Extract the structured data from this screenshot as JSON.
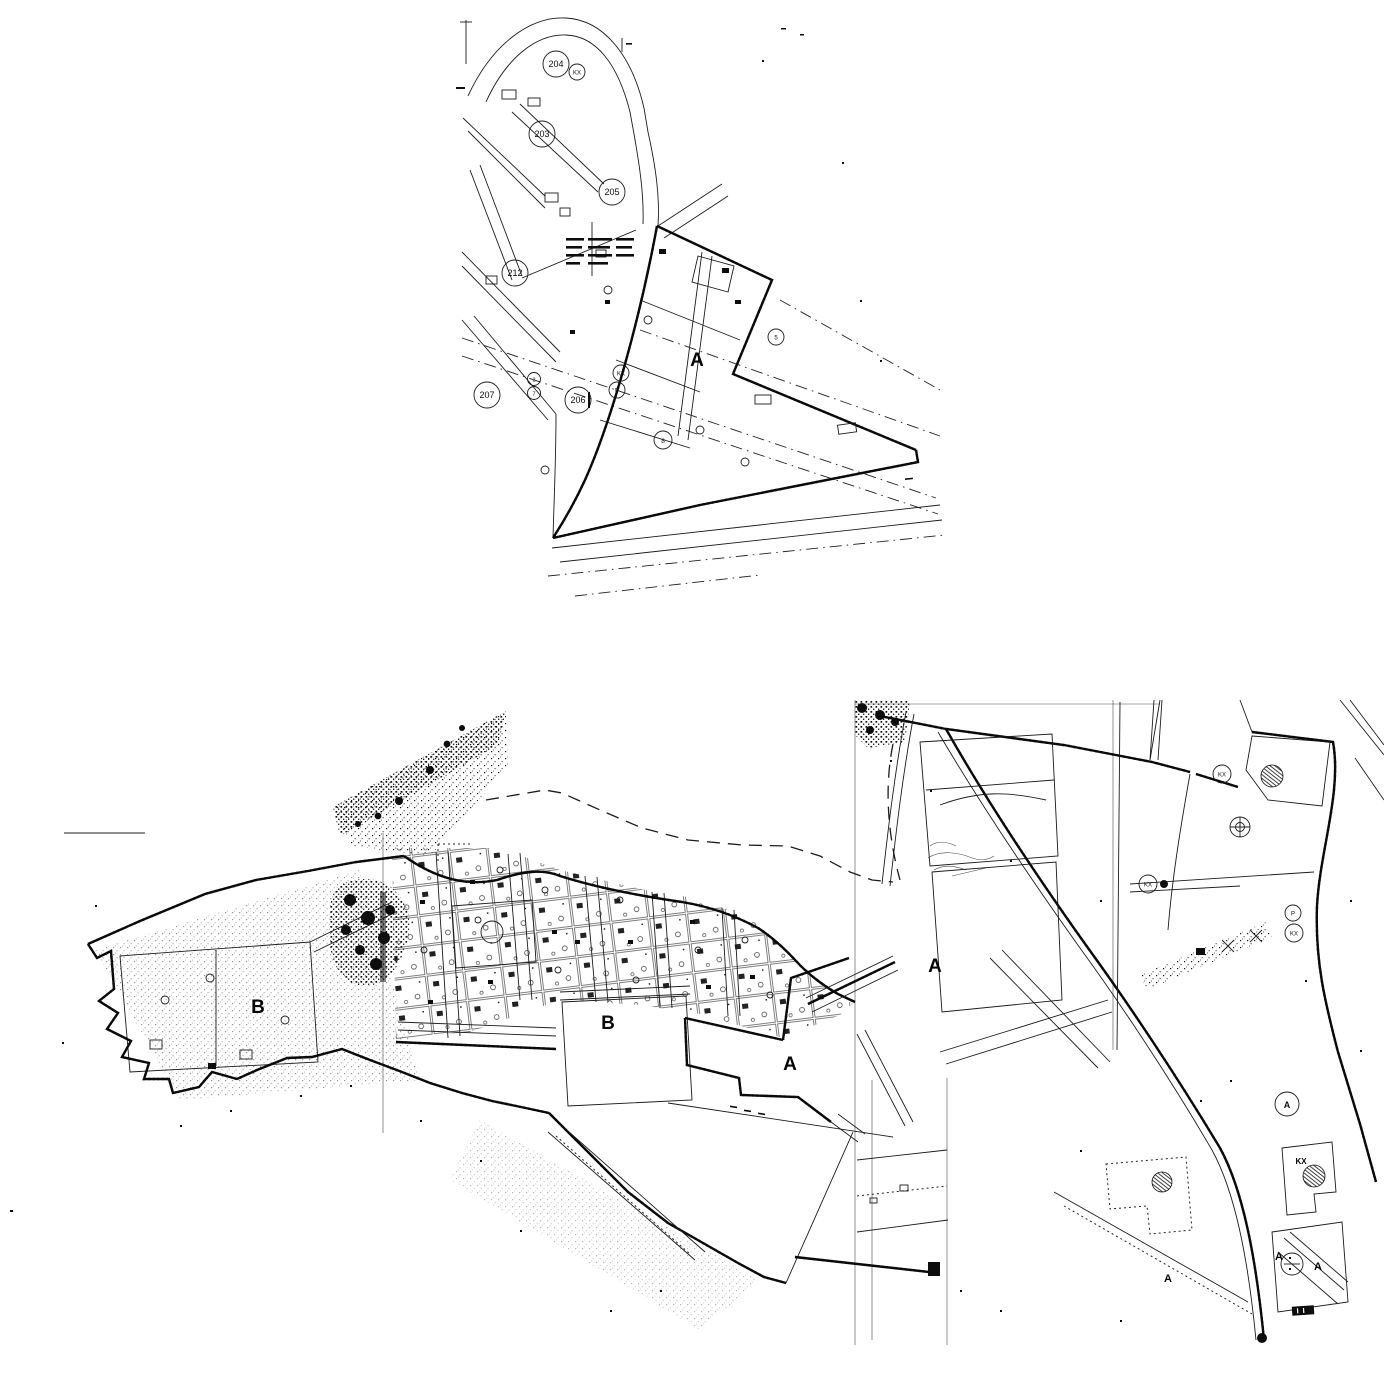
{
  "artifact": {
    "kind": "scanned cadastral map, two sheet fragments",
    "paper_color": "#ffffff",
    "ink_color": "#101010"
  },
  "top_map": {
    "zone_label": "A",
    "parcel_circles": [
      {
        "label": "204"
      },
      {
        "label": "KX"
      },
      {
        "label": "203"
      },
      {
        "label": "205"
      },
      {
        "label": "212"
      },
      {
        "label": "2"
      },
      {
        "label": "7"
      },
      {
        "label": "207"
      },
      {
        "label": "206"
      },
      {
        "label": "KX"
      },
      {
        "label": "P"
      },
      {
        "label": "8"
      },
      {
        "label": "5"
      }
    ]
  },
  "bottom_map": {
    "region_labels": [
      {
        "text": "B"
      },
      {
        "text": "B"
      },
      {
        "text": "A"
      },
      {
        "text": "A"
      }
    ],
    "small_labels": [
      {
        "text": "A"
      },
      {
        "text": "A"
      },
      {
        "text": "A"
      },
      {
        "text": "KX"
      }
    ],
    "circled_labels": [
      {
        "text": "A"
      },
      {
        "text": "KX"
      },
      {
        "text": "KX"
      },
      {
        "text": "P"
      },
      {
        "text": "KX"
      }
    ]
  }
}
